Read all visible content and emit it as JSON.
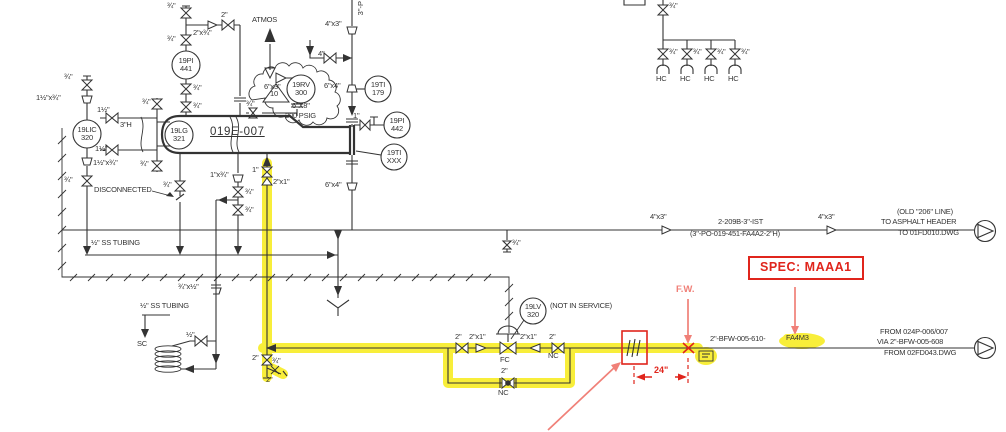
{
  "colors": {
    "line": "#333333",
    "red": "#e0251c",
    "coral": "#f08078",
    "highlight": "#f8ee3a",
    "background": "#ffffff"
  },
  "diagram": {
    "labels": [
      {
        "id": "size-3-4-vent-top",
        "t": "¾\"",
        "x": 167,
        "y": 2,
        "c": "s"
      },
      {
        "id": "size-2-top",
        "t": "2\"",
        "x": 221,
        "y": 11,
        "c": "s"
      },
      {
        "id": "size-2x3-4",
        "t": "2\"x¾\"",
        "x": 193,
        "y": 29,
        "c": "s"
      },
      {
        "id": "size-3-4-vent-bot",
        "t": "¾\"",
        "x": 167,
        "y": 35,
        "c": "s"
      },
      {
        "id": "atmos-label",
        "t": "ATMOS",
        "x": 252,
        "y": 16,
        "c": "s"
      },
      {
        "id": "size-4x3-top",
        "t": "4\"x3\"",
        "x": 325,
        "y": 20,
        "c": "s"
      },
      {
        "id": "line-3in-vertical",
        "t": "3\"-P",
        "x": 357,
        "y": 1,
        "c": "v"
      },
      {
        "id": "size-4",
        "t": "4\"",
        "x": 318,
        "y": 50,
        "c": "s"
      },
      {
        "id": "size-3-4-pi441-1",
        "t": "¾\"",
        "x": 193,
        "y": 84,
        "c": "s"
      },
      {
        "id": "size-3-4-pi441-2",
        "t": "¾\"",
        "x": 193,
        "y": 102,
        "c": "s"
      },
      {
        "id": "size-6x3",
        "t": "6\"x3\"",
        "x": 264,
        "y": 83,
        "c": "s"
      },
      {
        "id": "size-3-4-rv-drain",
        "t": "¾\"",
        "x": 246,
        "y": 100,
        "c": "s"
      },
      {
        "id": "rv-size",
        "t": "6\"X8\"",
        "x": 292,
        "y": 102,
        "c": "s"
      },
      {
        "id": "rv-rating",
        "t": "200 PSIG",
        "x": 285,
        "y": 112,
        "c": "s"
      },
      {
        "id": "rev-triangle-10",
        "t": "10",
        "x": 270,
        "y": 90,
        "c": "s"
      },
      {
        "id": "size-6x4-top",
        "t": "6\"x4\"",
        "x": 324,
        "y": 82,
        "c": "s"
      },
      {
        "id": "size-1-pi442",
        "t": "1\"",
        "x": 353,
        "y": 112,
        "c": "s"
      },
      {
        "id": "size-3-4-bridle-top",
        "t": "¾\"",
        "x": 142,
        "y": 98,
        "c": "s"
      },
      {
        "id": "size-1half-top",
        "t": "1½\"",
        "x": 97,
        "y": 106,
        "c": "s"
      },
      {
        "id": "size-1halfx3-4-top",
        "t": "1½\"x¾\"",
        "x": 36,
        "y": 94,
        "c": "s"
      },
      {
        "id": "size-3-4-lic-top",
        "t": "¾\"",
        "x": 64,
        "y": 73,
        "c": "s"
      },
      {
        "id": "vessel-internal-3h",
        "t": "3\"H",
        "x": 120,
        "y": 121,
        "c": "s"
      },
      {
        "id": "vessel-tag",
        "t": "019E-007",
        "x": 210,
        "y": 126,
        "c": "big"
      },
      {
        "id": "size-1half-bot",
        "t": "1½\"",
        "x": 95,
        "y": 145,
        "c": "s"
      },
      {
        "id": "size-1halfx3-4-bot",
        "t": "1½\"x¾\"",
        "x": 93,
        "y": 159,
        "c": "s"
      },
      {
        "id": "size-3-4-lic-bot",
        "t": "¾\"",
        "x": 64,
        "y": 176,
        "c": "s"
      },
      {
        "id": "size-3-4-bridle-bot",
        "t": "¾\"",
        "x": 140,
        "y": 160,
        "c": "s"
      },
      {
        "id": "disconnected-note",
        "t": "DISCONNECTED",
        "x": 94,
        "y": 186,
        "c": "s"
      },
      {
        "id": "size-3-4-disc",
        "t": "¾\"",
        "x": 163,
        "y": 181,
        "c": "s"
      },
      {
        "id": "size-1x3-4",
        "t": "1\"x¾\"",
        "x": 210,
        "y": 171,
        "c": "s"
      },
      {
        "id": "size-1-bfw-inlet",
        "t": "1\"",
        "x": 252,
        "y": 166,
        "c": "s"
      },
      {
        "id": "size-2x1-bfw-inlet",
        "t": "2\"x1\"",
        "x": 273,
        "y": 178,
        "c": "s"
      },
      {
        "id": "size-3-4-drainstack-1",
        "t": "¾\"",
        "x": 245,
        "y": 188,
        "c": "s"
      },
      {
        "id": "size-3-4-drainstack-2",
        "t": "¾\"",
        "x": 245,
        "y": 206,
        "c": "s"
      },
      {
        "id": "size-6x4-bot",
        "t": "6\"x4\"",
        "x": 325,
        "y": 181,
        "c": "s"
      },
      {
        "id": "ss-tubing-note-1",
        "t": "½\" SS TUBING",
        "x": 91,
        "y": 239,
        "c": "s"
      },
      {
        "id": "size-3-4x1-2",
        "t": "¾\"x½\"",
        "x": 178,
        "y": 283,
        "c": "s"
      },
      {
        "id": "ss-tubing-note-2",
        "t": "½\" SS TUBING",
        "x": 140,
        "y": 302,
        "c": "s"
      },
      {
        "id": "sample-cooler-sc",
        "t": "SC",
        "x": 137,
        "y": 340,
        "c": "s"
      },
      {
        "id": "size-1-2-sc",
        "t": "½\"",
        "x": 186,
        "y": 331,
        "c": "s"
      },
      {
        "id": "size-2-drain",
        "t": "2\"",
        "x": 252,
        "y": 354,
        "c": "s"
      },
      {
        "id": "size-3-4-drain",
        "t": "¾\"",
        "x": 272,
        "y": 357,
        "c": "s"
      },
      {
        "id": "size-2-drain-2",
        "t": "2\"",
        "x": 266,
        "y": 376,
        "c": "s"
      },
      {
        "id": "size-3-4-ist-drain",
        "t": "¾\"",
        "x": 512,
        "y": 239,
        "c": "s"
      },
      {
        "id": "size-4x3-ist-1",
        "t": "4\"x3\"",
        "x": 650,
        "y": 213,
        "c": "s"
      },
      {
        "id": "ist-line-number",
        "t": "2-209B-3\"-IST",
        "x": 718,
        "y": 218,
        "c": "s"
      },
      {
        "id": "ist-line-old-number",
        "t": "(3\"-PO-019-451-FA4A2-2\"H)",
        "x": 690,
        "y": 230,
        "c": "s"
      },
      {
        "id": "size-4x3-ist-2",
        "t": "4\"x3\"",
        "x": 818,
        "y": 213,
        "c": "s"
      },
      {
        "id": "old-206-line-note",
        "t": "(OLD \"206\" LINE)",
        "x": 897,
        "y": 208,
        "c": "s"
      },
      {
        "id": "to-asphalt-header",
        "t": "TO ASPHALT HEADER",
        "x": 881,
        "y": 218,
        "c": "s"
      },
      {
        "id": "to-01fd010",
        "t": "TO 01FD010.DWG",
        "x": 898,
        "y": 229,
        "c": "s"
      },
      {
        "id": "fw-note",
        "t": "F.W.",
        "x": 676,
        "y": 285,
        "c": "coral"
      },
      {
        "id": "dim-24in",
        "t": "24\"",
        "x": 654,
        "y": 366,
        "c": "red"
      },
      {
        "id": "bfw-line-number",
        "t": "2\"-BFW-005-610-",
        "x": 710,
        "y": 335,
        "c": "s"
      },
      {
        "id": "bfw-spec-fa4m3",
        "t": "FA4M3",
        "x": 783,
        "y": 334,
        "c": "s hl"
      },
      {
        "id": "from-024p",
        "t": "FROM 024P-006/007",
        "x": 880,
        "y": 328,
        "c": "s"
      },
      {
        "id": "via-bfw-608",
        "t": "VIA 2\"-BFW-005-608",
        "x": 877,
        "y": 338,
        "c": "s"
      },
      {
        "id": "from-02fd043",
        "t": "FROM 02FD043.DWG",
        "x": 884,
        "y": 349,
        "c": "s"
      },
      {
        "id": "size-2-lv-up",
        "t": "2\"",
        "x": 455,
        "y": 333,
        "c": "s"
      },
      {
        "id": "size-2x1-lv-up",
        "t": "2\"x1\"",
        "x": 469,
        "y": 333,
        "c": "s"
      },
      {
        "id": "size-2x1-lv-dn",
        "t": "2\"x1\"",
        "x": 520,
        "y": 333,
        "c": "s"
      },
      {
        "id": "size-2-lv-dn",
        "t": "2\"",
        "x": 549,
        "y": 333,
        "c": "s"
      },
      {
        "id": "nc-block-valve",
        "t": "NC",
        "x": 548,
        "y": 352,
        "c": "s"
      },
      {
        "id": "fc-control-valve",
        "t": "FC",
        "x": 500,
        "y": 356,
        "c": "s"
      },
      {
        "id": "size-2-bypass",
        "t": "2\"",
        "x": 501,
        "y": 367,
        "c": "s"
      },
      {
        "id": "nc-bypass-valve",
        "t": "NC",
        "x": 498,
        "y": 389,
        "c": "s"
      },
      {
        "id": "not-in-service-note",
        "t": "(NOT IN SERVICE)",
        "x": 550,
        "y": 302,
        "c": "s"
      },
      {
        "id": "size-3-4-hc-top",
        "t": "¾\"",
        "x": 669,
        "y": 2,
        "c": "s"
      },
      {
        "id": "size-3-4-hc-1",
        "t": "¾\"",
        "x": 669,
        "y": 48,
        "c": "s"
      },
      {
        "id": "size-3-4-hc-2",
        "t": "¾\"",
        "x": 693,
        "y": 48,
        "c": "s"
      },
      {
        "id": "size-3-4-hc-3",
        "t": "¾\"",
        "x": 717,
        "y": 48,
        "c": "s"
      },
      {
        "id": "size-3-4-hc-4",
        "t": "¾\"",
        "x": 741,
        "y": 48,
        "c": "s"
      },
      {
        "id": "hc-1",
        "t": "HC",
        "x": 656,
        "y": 75,
        "c": "s"
      },
      {
        "id": "hc-2",
        "t": "HC",
        "x": 680,
        "y": 75,
        "c": "s"
      },
      {
        "id": "hc-3",
        "t": "HC",
        "x": 704,
        "y": 75,
        "c": "s"
      },
      {
        "id": "hc-4",
        "t": "HC",
        "x": 728,
        "y": 75,
        "c": "s"
      },
      {
        "id": "inst-19pi-441",
        "t": "19PI\n441",
        "x": 186,
        "y": 65,
        "c": "b"
      },
      {
        "id": "inst-19rv-300",
        "t": "19RV\n300",
        "x": 301,
        "y": 89,
        "c": "b"
      },
      {
        "id": "inst-19ti-179",
        "t": "19TI\n179",
        "x": 378,
        "y": 89,
        "c": "b"
      },
      {
        "id": "inst-19pi-442",
        "t": "19PI\n442",
        "x": 397,
        "y": 125,
        "c": "b"
      },
      {
        "id": "inst-19ti-xxx",
        "t": "19TI\nXXX",
        "x": 394,
        "y": 157,
        "c": "b"
      },
      {
        "id": "inst-19lic-320",
        "t": "19LIC\n320",
        "x": 87,
        "y": 134,
        "c": "b"
      },
      {
        "id": "inst-19lg-321",
        "t": "19LG\n321",
        "x": 179,
        "y": 135,
        "c": "b"
      },
      {
        "id": "inst-19lv-320",
        "t": "19LV\n320",
        "x": 533,
        "y": 311,
        "c": "b"
      },
      {
        "id": "spec-callout",
        "t": "SPEC: MAAA1",
        "x": 748,
        "y": 256,
        "c": "specbox"
      }
    ]
  }
}
